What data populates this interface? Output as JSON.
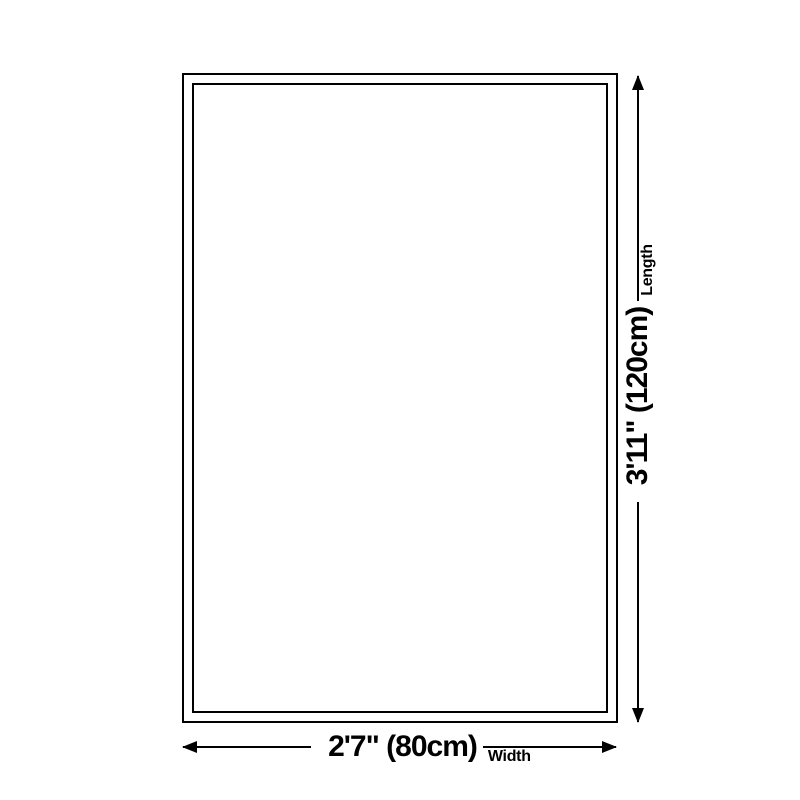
{
  "page": {
    "background": "#ffffff",
    "line_color": "#000000",
    "text_color": "#000000"
  },
  "diagram": {
    "type": "product-dimensions",
    "shape": "rectangle",
    "dimensions": {
      "length": {
        "value": "3'11\" (120cm)",
        "label": "Length"
      },
      "width": {
        "value": "2'7\" (80cm)",
        "label": "Width"
      }
    }
  }
}
